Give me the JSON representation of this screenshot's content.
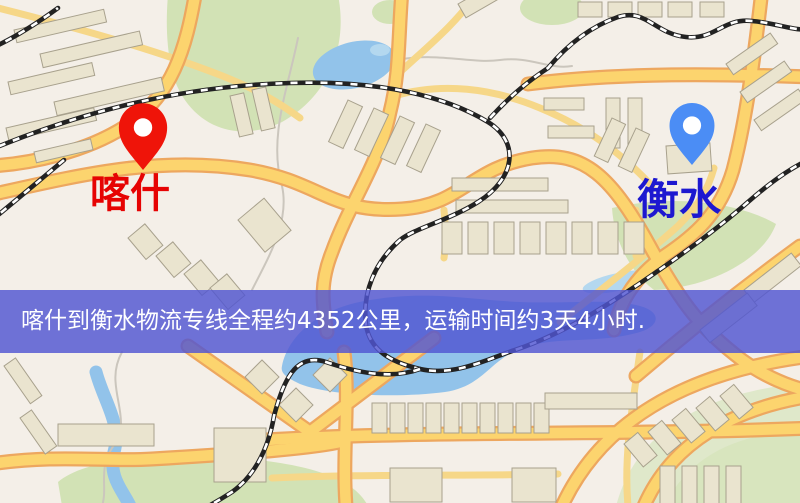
{
  "map": {
    "markers": {
      "origin": {
        "name": "喀什",
        "pin_icon": "red-location-pin",
        "pin_color": "#ef1409",
        "label_color": "#e60303"
      },
      "destination": {
        "name": "衡水",
        "pin_icon": "blue-location-pin",
        "pin_color": "#4b8df5",
        "label_color": "#1d18d0"
      }
    },
    "banner": {
      "text": "喀什到衡水物流专线全程约4352公里，运输时间约3天4小时.",
      "distance_km": "4352",
      "duration": "3天4小时",
      "background_color": "#5056d2",
      "text_color": "#ffffff"
    },
    "palette": {
      "background": "#f4efe8",
      "road_fill": "#fcd46e",
      "road_casing": "#eda75f",
      "park": "#d2e2b5",
      "water": "#92c3ea",
      "building": "#eae4cf",
      "railway": "#222222"
    }
  }
}
